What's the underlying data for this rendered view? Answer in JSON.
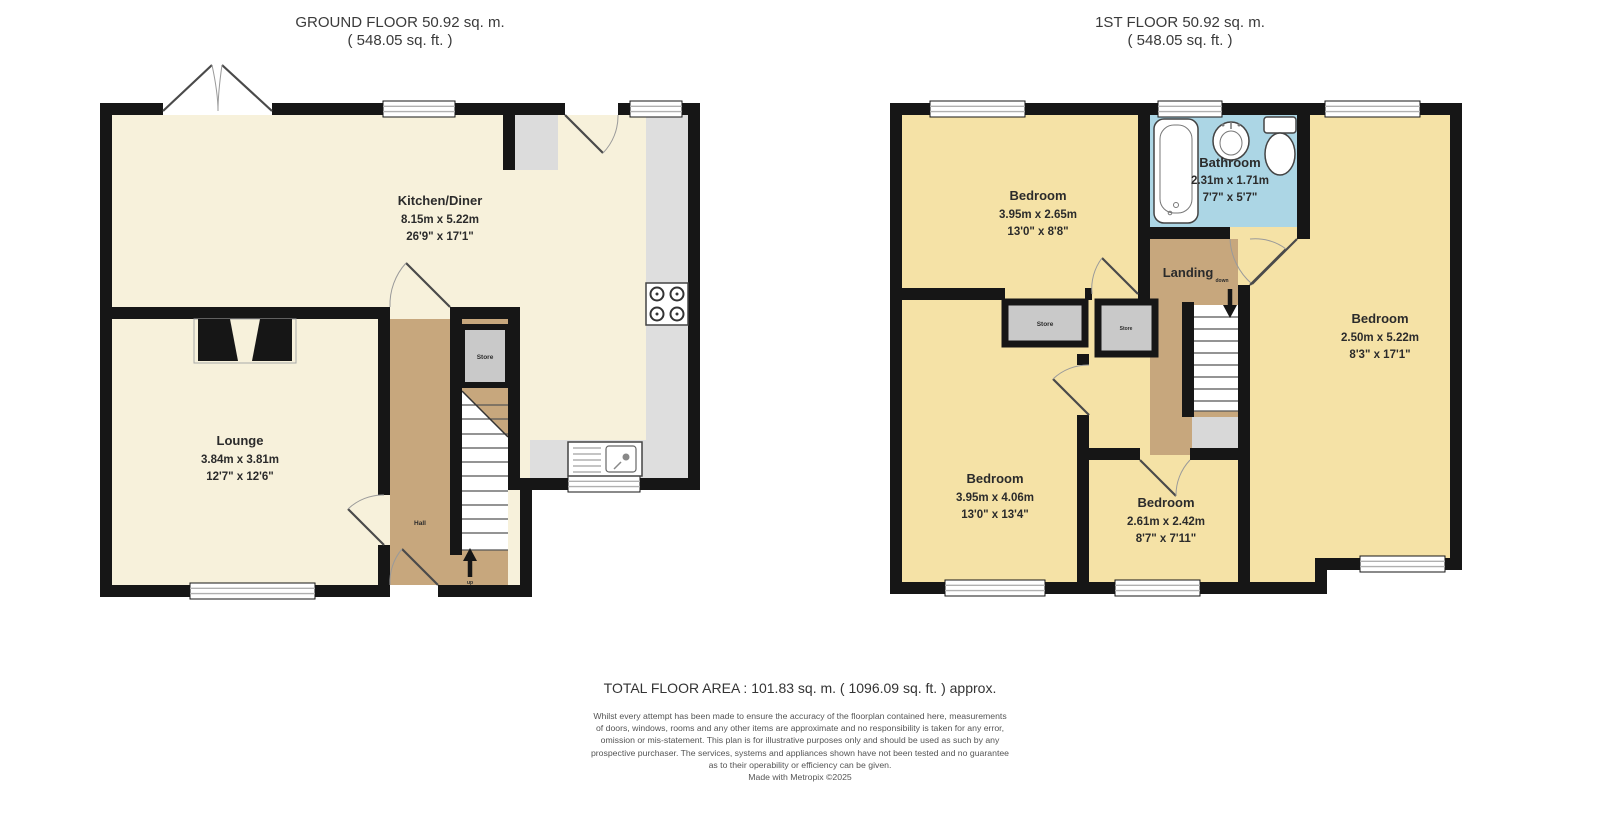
{
  "colors": {
    "wall": "#161616",
    "ground_room_fill": "#F7F1DB",
    "first_room_fill": "#F5E2A6",
    "hall_landing_fill": "#C7A77D",
    "store_fill": "#C9C9C9",
    "bathroom_fill": "#ACD6E5",
    "counter_fill": "#DEDEDE",
    "text": "#2b2b2b"
  },
  "ground_floor": {
    "title": "GROUND FLOOR 50.92 sq. m.",
    "subtitle": "( 548.05 sq. ft. )",
    "kitchen": {
      "name": "Kitchen/Diner",
      "metric": "8.15m x 5.22m",
      "imperial": "26'9\" x 17'1\""
    },
    "lounge": {
      "name": "Lounge",
      "metric": "3.84m x 3.81m",
      "imperial": "12'7\" x 12'6\""
    },
    "hall_label": "Hall",
    "store_label": "Store",
    "stairs_label": "up"
  },
  "first_floor": {
    "title": "1ST FLOOR 50.92 sq. m.",
    "subtitle": "( 548.05 sq. ft. )",
    "bathroom": {
      "name": "Bathroom",
      "metric": "2.31m x 1.71m",
      "imperial": "7'7\" x 5'7\""
    },
    "bedroom_front": {
      "name": "Bedroom",
      "metric": "3.95m x 2.65m",
      "imperial": "13'0\" x 8'8\""
    },
    "bedroom_side": {
      "name": "Bedroom",
      "metric": "2.50m x 5.22m",
      "imperial": "8'3\" x 17'1\""
    },
    "bedroom_back": {
      "name": "Bedroom",
      "metric": "3.95m x 4.06m",
      "imperial": "13'0\" x 13'4\""
    },
    "bedroom_small": {
      "name": "Bedroom",
      "metric": "2.61m x 2.42m",
      "imperial": "8'7\" x 7'11\""
    },
    "landing_label": "Landing",
    "store_large_label": "Store",
    "store_small_label": "Store",
    "stairs_label": "down"
  },
  "footer": {
    "total_area": "TOTAL FLOOR AREA : 101.83 sq. m. ( 1096.09 sq. ft. ) approx.",
    "disclaimer_lines": [
      "Whilst every attempt has been made to ensure the accuracy of the floorplan contained here, measurements",
      "of doors, windows, rooms and any other items are approximate and no responsibility is taken for any error,",
      "omission or mis-statement. This plan is for illustrative purposes only and should be used as such by any",
      "prospective purchaser. The services, systems and appliances shown have not been tested and no guarantee",
      "as to their operability or efficiency can be given."
    ],
    "credit": "Made with Metropix ©2025"
  }
}
